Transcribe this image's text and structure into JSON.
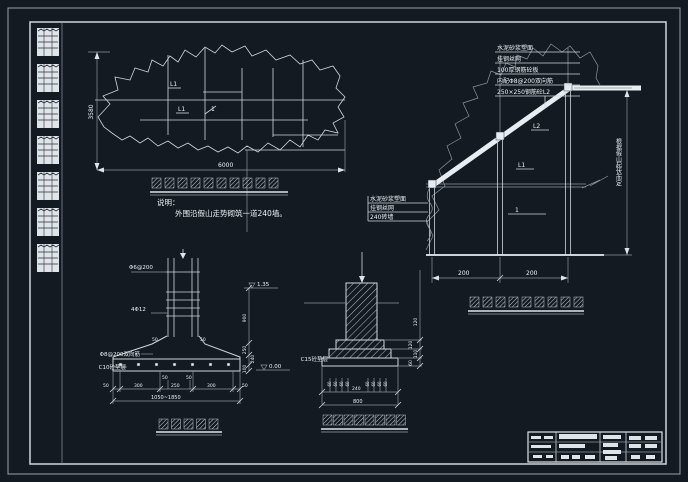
{
  "colors": {
    "background": "#131a22",
    "line": "#cfd6dc",
    "line_dim": "#8d959e",
    "text": "#eef2f5",
    "white": "#e8edf2"
  },
  "notes": {
    "heading": "说明：",
    "line1": "外围沿假山走势砌筑一道240墙。"
  },
  "plan": {
    "dim_width": "6000",
    "dim_height": "3580",
    "label_l1_a": "L1",
    "label_l1_b": "L1",
    "label_1": "1"
  },
  "section": {
    "leader_top": [
      "水泥砂浆塑面",
      "挂钢丝网",
      "100厚钢筋砼板",
      "内配Φ8@200双向筋",
      "250×250钢筋砼L2"
    ],
    "leader_wall": [
      "水泥砂浆塑面",
      "挂钢丝网",
      "240砖墙"
    ],
    "note_vertical": "根据假山起伏而定",
    "label_l2": "L2",
    "label_l1": "L1",
    "label_1": "1",
    "dim_bay1": "200",
    "dim_bay2": "200"
  },
  "footing_left": {
    "label_tie": "Φ6@200",
    "label_bars": "4Φ12",
    "label_mesh": "Φ8@200双向筋",
    "label_cushion": "C10砼垫层",
    "elev_top": "1.35",
    "elev_bottom": "0.00",
    "dims_right": [
      "900",
      "250",
      "240",
      "100"
    ],
    "dims_shoulder": [
      "50",
      "50"
    ],
    "dims_center_small": [
      "50",
      "50"
    ],
    "dims_bottom": [
      "50",
      "300",
      "250",
      "300",
      "50"
    ],
    "dim_total": "1050~1850"
  },
  "footing_mid": {
    "label_cushion": "C15砼垫层",
    "dims_right": [
      "120",
      "120",
      "110",
      "60"
    ],
    "dims_small": [
      "60",
      "60",
      "60",
      "60",
      "60",
      "60",
      "60",
      "60"
    ],
    "dim_center": "240",
    "dim_total": "800"
  },
  "captions": {
    "plan_glyphs": 10,
    "section_glyphs": 9,
    "footing_left_glyphs": 5,
    "footing_mid_glyphs": 8
  }
}
